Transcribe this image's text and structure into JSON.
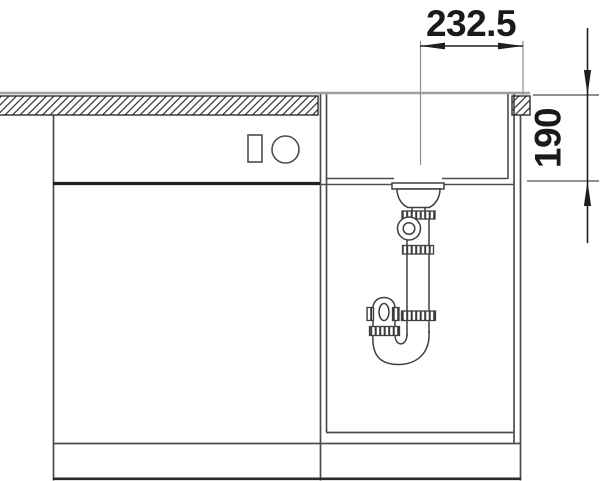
{
  "diagram": {
    "kind": "sink-installation-side-view",
    "dim_width": {
      "label": "232.5"
    },
    "dim_depth": {
      "label": "190"
    }
  },
  "colors": {
    "background": "#ffffff",
    "line": "#4d4d4d",
    "line_dark": "#1f1f1f",
    "surface_gray": "#9e9e9e",
    "hatch": "#3a3a3a",
    "text": "#1a1a1a"
  }
}
